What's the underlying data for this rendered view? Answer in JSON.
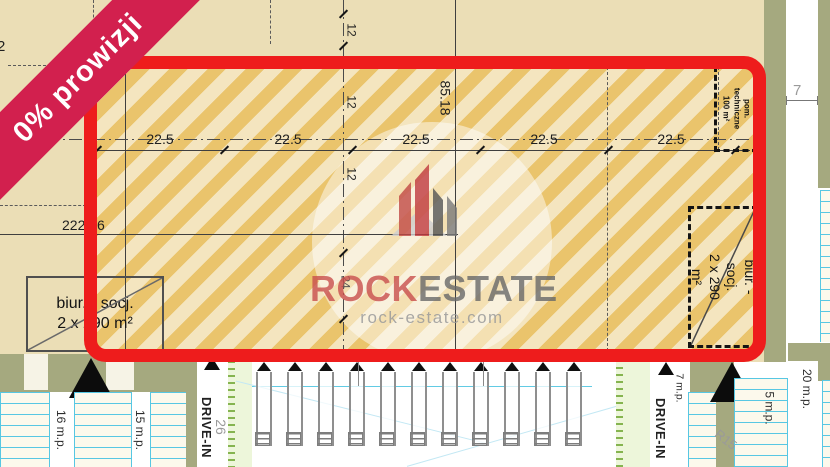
{
  "banner": {
    "label": "0% prowizji"
  },
  "logo": {
    "rock": "ROCK",
    "estate": "ESTATE",
    "site": "rock-estate.com"
  },
  "dims": {
    "top_widths": [
      "22.5",
      "22.5",
      "22.5",
      "22.5",
      "22.5"
    ],
    "height": "85.18",
    "total": "222.86",
    "bay_depths": [
      "12",
      "12",
      "12"
    ],
    "bay24": "24",
    "edge_cut": "2",
    "offset_right": "7",
    "drive_width": "26",
    "radius": "R15"
  },
  "rooms": {
    "office_left": {
      "l1": "biur. - socj.",
      "l2": "2 x 290 m²"
    },
    "office_right": {
      "l1": "biur. - socj.",
      "l2": "2 x 290 m²"
    },
    "tech": {
      "l1": "pom. techniczne",
      "l2": "100 m²"
    }
  },
  "roads": {
    "drive_in": "DRIVE-IN"
  },
  "parking": {
    "p16": "16 m.p.",
    "p15": "15 m.p.",
    "p7": "7 m.p.",
    "p5": "5 m.p.",
    "p20": "20 m.p."
  },
  "docks": {
    "count": 11
  },
  "colors": {
    "highlight_red": "#ee1c1c",
    "banner_red": "#d2204e",
    "hatch_orange": "#eac46c",
    "plan_tan": "#ebdeb6",
    "olive_green": "#a5a97f",
    "stall_blue": "#57c7e3"
  }
}
